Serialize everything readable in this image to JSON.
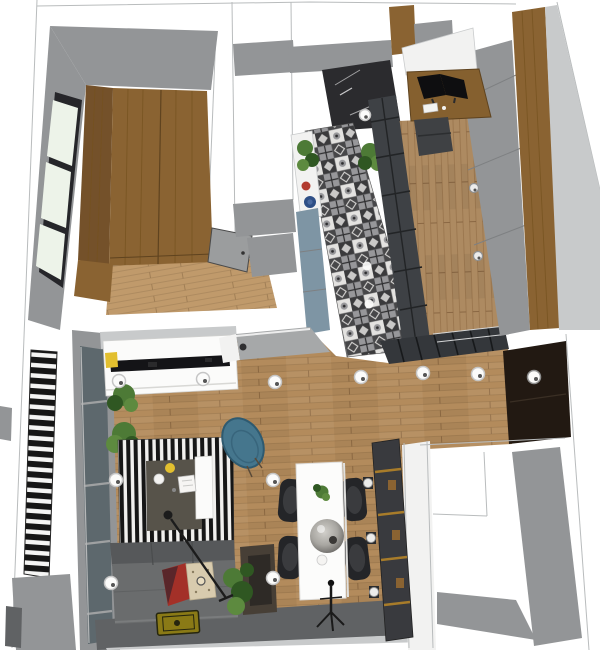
{
  "meta": {
    "description": "3D top-down render of a small apartment floor plan (SketchUp style)",
    "canvas_width": 600,
    "canvas_height": 650
  },
  "palette": {
    "canvas": "#ffffff",
    "outline": "#b9bcbd",
    "wall_white": "#f2f2f1",
    "wall_gray": "#939597",
    "wall_gray_light": "#c8cacb",
    "wall_gray_dark": "#606264",
    "wood_wardrobe": "#8a6332",
    "wood_wardrobe_dark": "#74512a",
    "floor_living": "#b38b5c",
    "floor_bedroom": "#c09a6b",
    "floor_hall": "#ad8a61",
    "window_glass": "#edf3e9",
    "frame_dark": "#26262a",
    "glass_gray": "#5d686d",
    "tile_dark": "#3a3a3c",
    "tile_light": "#e3e2e0",
    "tile_mid": "#97979a",
    "cabinet_blue": "#7e95a4",
    "partition_dark": "#34373b",
    "counter_gray": "#a6a8a9",
    "console_white": "#fbfbfa",
    "tv_black": "#141417",
    "sofa_gray": "#6a6c6d",
    "sofa_dark": "#56585a",
    "rug_black": "#161616",
    "rug_white": "#f1f0ee",
    "rug_center": "#57534a",
    "armchair_blue": "#45768d",
    "table_white": "#fcfcfb",
    "chair_black": "#242528",
    "pendant_gray": "#a8a6a1",
    "shelf_dark": "#393a3e",
    "brass_gold": "#a87c2a",
    "entry_dark": "#221912",
    "plant_green": "#4d7a36",
    "plant_green_light": "#5d8a3f",
    "plant_green_dark": "#2f5722",
    "accent_yellow": "#e2bf2f",
    "accent_red": "#b23a2e",
    "accent_blue": "#2e4f86",
    "pillow_red": "#a33028",
    "pillow_beige": "#d8cbae",
    "mat_olive": "#8a7a16",
    "spot_white": "#fbfbfa",
    "desk_wood": "#85602f",
    "chair_office": "#3f4144",
    "door_gray": "#9b9d9e"
  },
  "scene": {
    "type": "3d-floorplan-top-view",
    "rooms": [
      {
        "name": "bedroom",
        "furniture": [
          "wood-wardrobe",
          "paned-window",
          "gray-door",
          "wood-floor"
        ]
      },
      {
        "name": "kitchen",
        "furniture": [
          "patchwork-tile-floor",
          "blue-gray-cabinet",
          "white-counter",
          "red-kettle",
          "blue-bowl",
          "plants",
          "black-framed-glass-partition",
          "dark-range-area"
        ]
      },
      {
        "name": "hallway-office",
        "furniture": [
          "wood-desk",
          "dual-monitors",
          "keyboard",
          "office-chair",
          "tall-gray-wardrobe",
          "wood-side-panel"
        ]
      },
      {
        "name": "living-room",
        "furniture": [
          "white-tv-console",
          "tv",
          "striped-rug",
          "white-coffee-bench",
          "blue-armchair",
          "gray-sofa",
          "red-pillow",
          "beige-pillow",
          "arc-floor-lamp",
          "plants",
          "olive-doormat",
          "side-table"
        ]
      },
      {
        "name": "dining-area",
        "furniture": [
          "white-dining-table",
          "four-black-chairs",
          "gray-pendant-lamp",
          "tripod-floor-lamp",
          "dark-shelving-unit-with-brass"
        ]
      },
      {
        "name": "balcony",
        "furniture": [
          "striped-shutter",
          "glazed-sliding-wall",
          "gray-floor"
        ]
      },
      {
        "name": "entry",
        "furniture": [
          "dark-door-recess"
        ]
      },
      {
        "name": "adjacent-room",
        "furniture": [
          "bare-gray-walls"
        ]
      }
    ],
    "lighting": {
      "ceiling_spotlights": 12,
      "wardrobe_knobs": 3,
      "wall_lamps": 3
    }
  }
}
